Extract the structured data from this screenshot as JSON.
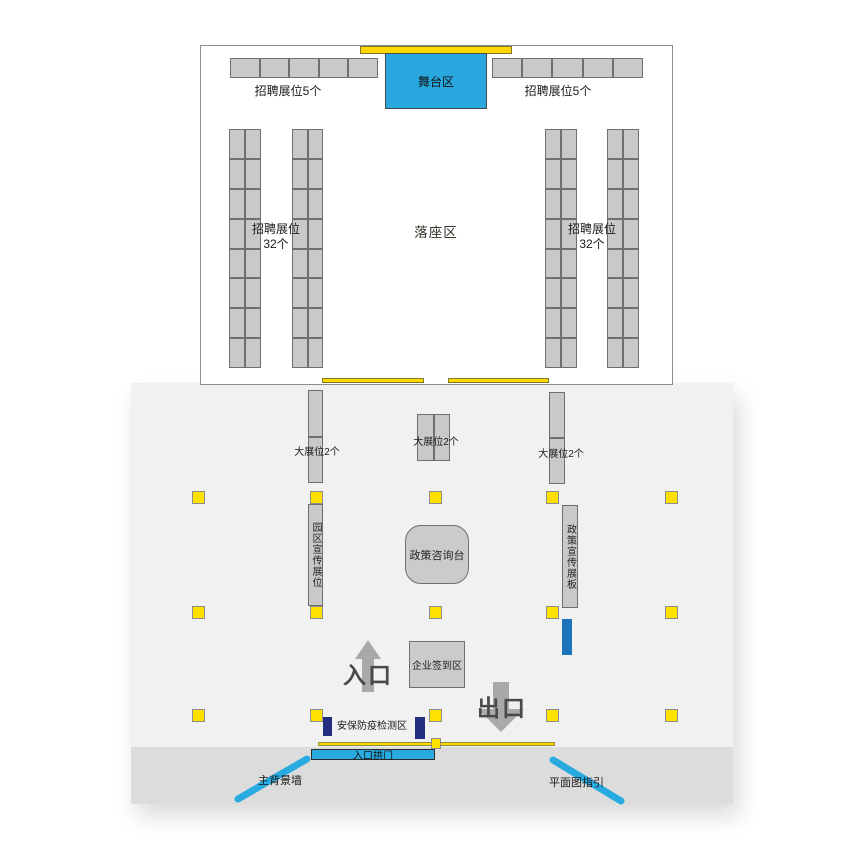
{
  "hall": {
    "stage": {
      "label": "舞台区"
    },
    "top_rows": [
      {
        "label": "招聘展位5个",
        "cells": 5
      },
      {
        "label": "招聘展位5个",
        "cells": 5
      }
    ],
    "column_groups": [
      {
        "label_line1": "招聘展位",
        "label_line2": "32个",
        "cells_per_column": 16
      },
      {
        "label_line1": "招聘展位",
        "label_line2": "32个",
        "cells_per_column": 16
      }
    ],
    "seating": {
      "label": "落座区"
    }
  },
  "plaza": {
    "large_booths": [
      {
        "label": "大展位2个",
        "cells": 2
      },
      {
        "label": "大展位2个",
        "cells": 2
      },
      {
        "label": "大展位2个",
        "cells": 2
      }
    ],
    "park_promo_booth": {
      "label": "园区宣传展位"
    },
    "policy_desk": {
      "label": "政策咨询台"
    },
    "policy_board": {
      "label": "政策宣传展板"
    },
    "checkin": {
      "label": "企业签到区"
    },
    "entrance": {
      "label": "入口"
    },
    "exit": {
      "label": "出口"
    },
    "security": {
      "label": "安保防疫检测区"
    },
    "arch": {
      "label": "入口拱门"
    },
    "backdrop": {
      "label": "主背景墙"
    },
    "map_guide": {
      "label": "平面图指引"
    },
    "pillar_grid": {
      "rows": 3,
      "columns": 5
    }
  },
  "colors": {
    "stage_blue": "#29a8e0",
    "arch_blue": "#29abe2",
    "booth_gray": "#c9c9c9",
    "accent_yellow": "#ffd800",
    "pillar_yellow": "#ffe100",
    "navy": "#232e80",
    "mid_blue": "#1c75bc",
    "panel_light": "#f1f1f1",
    "panel_dark": "#dcdcdc",
    "arrow_gray": "#a9a9a9"
  }
}
